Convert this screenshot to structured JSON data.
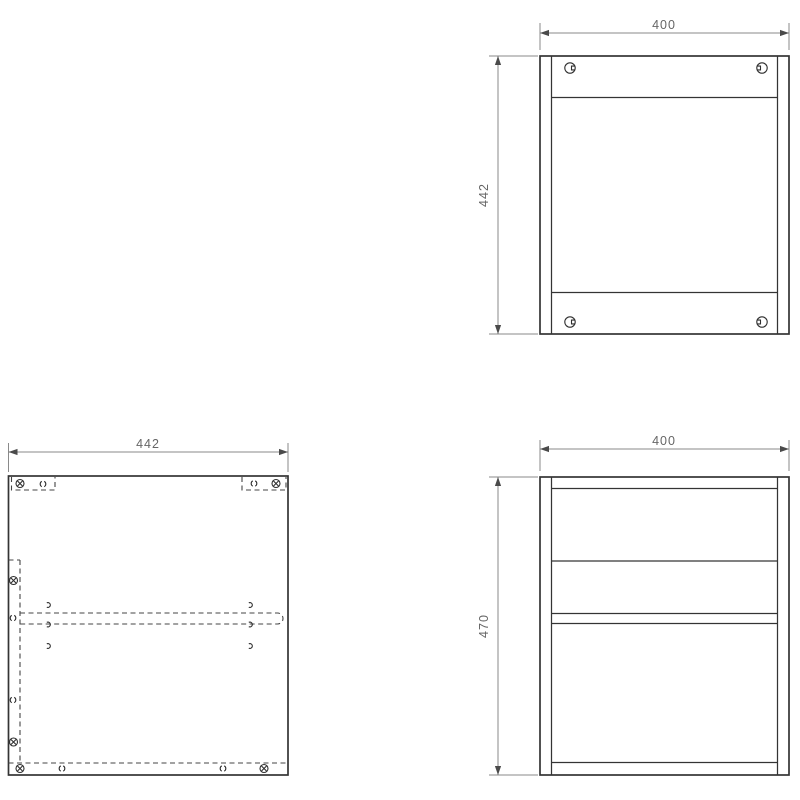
{
  "drawing": {
    "description": "furniture cabinet assembly orthographic views",
    "colors": {
      "background": "#ffffff",
      "outline": "#343434",
      "dimension_line": "#8a8a8a",
      "arrowhead": "#4a4a4a",
      "hidden_line": "#454545",
      "dimension_text": "#666666"
    },
    "views": {
      "back": {
        "name": "back panel view",
        "width_dim": "400",
        "height_dim": "442"
      },
      "side": {
        "name": "side panel view",
        "width_dim": "442"
      },
      "front": {
        "name": "front view",
        "width_dim": "400",
        "height_dim": "470"
      }
    }
  }
}
